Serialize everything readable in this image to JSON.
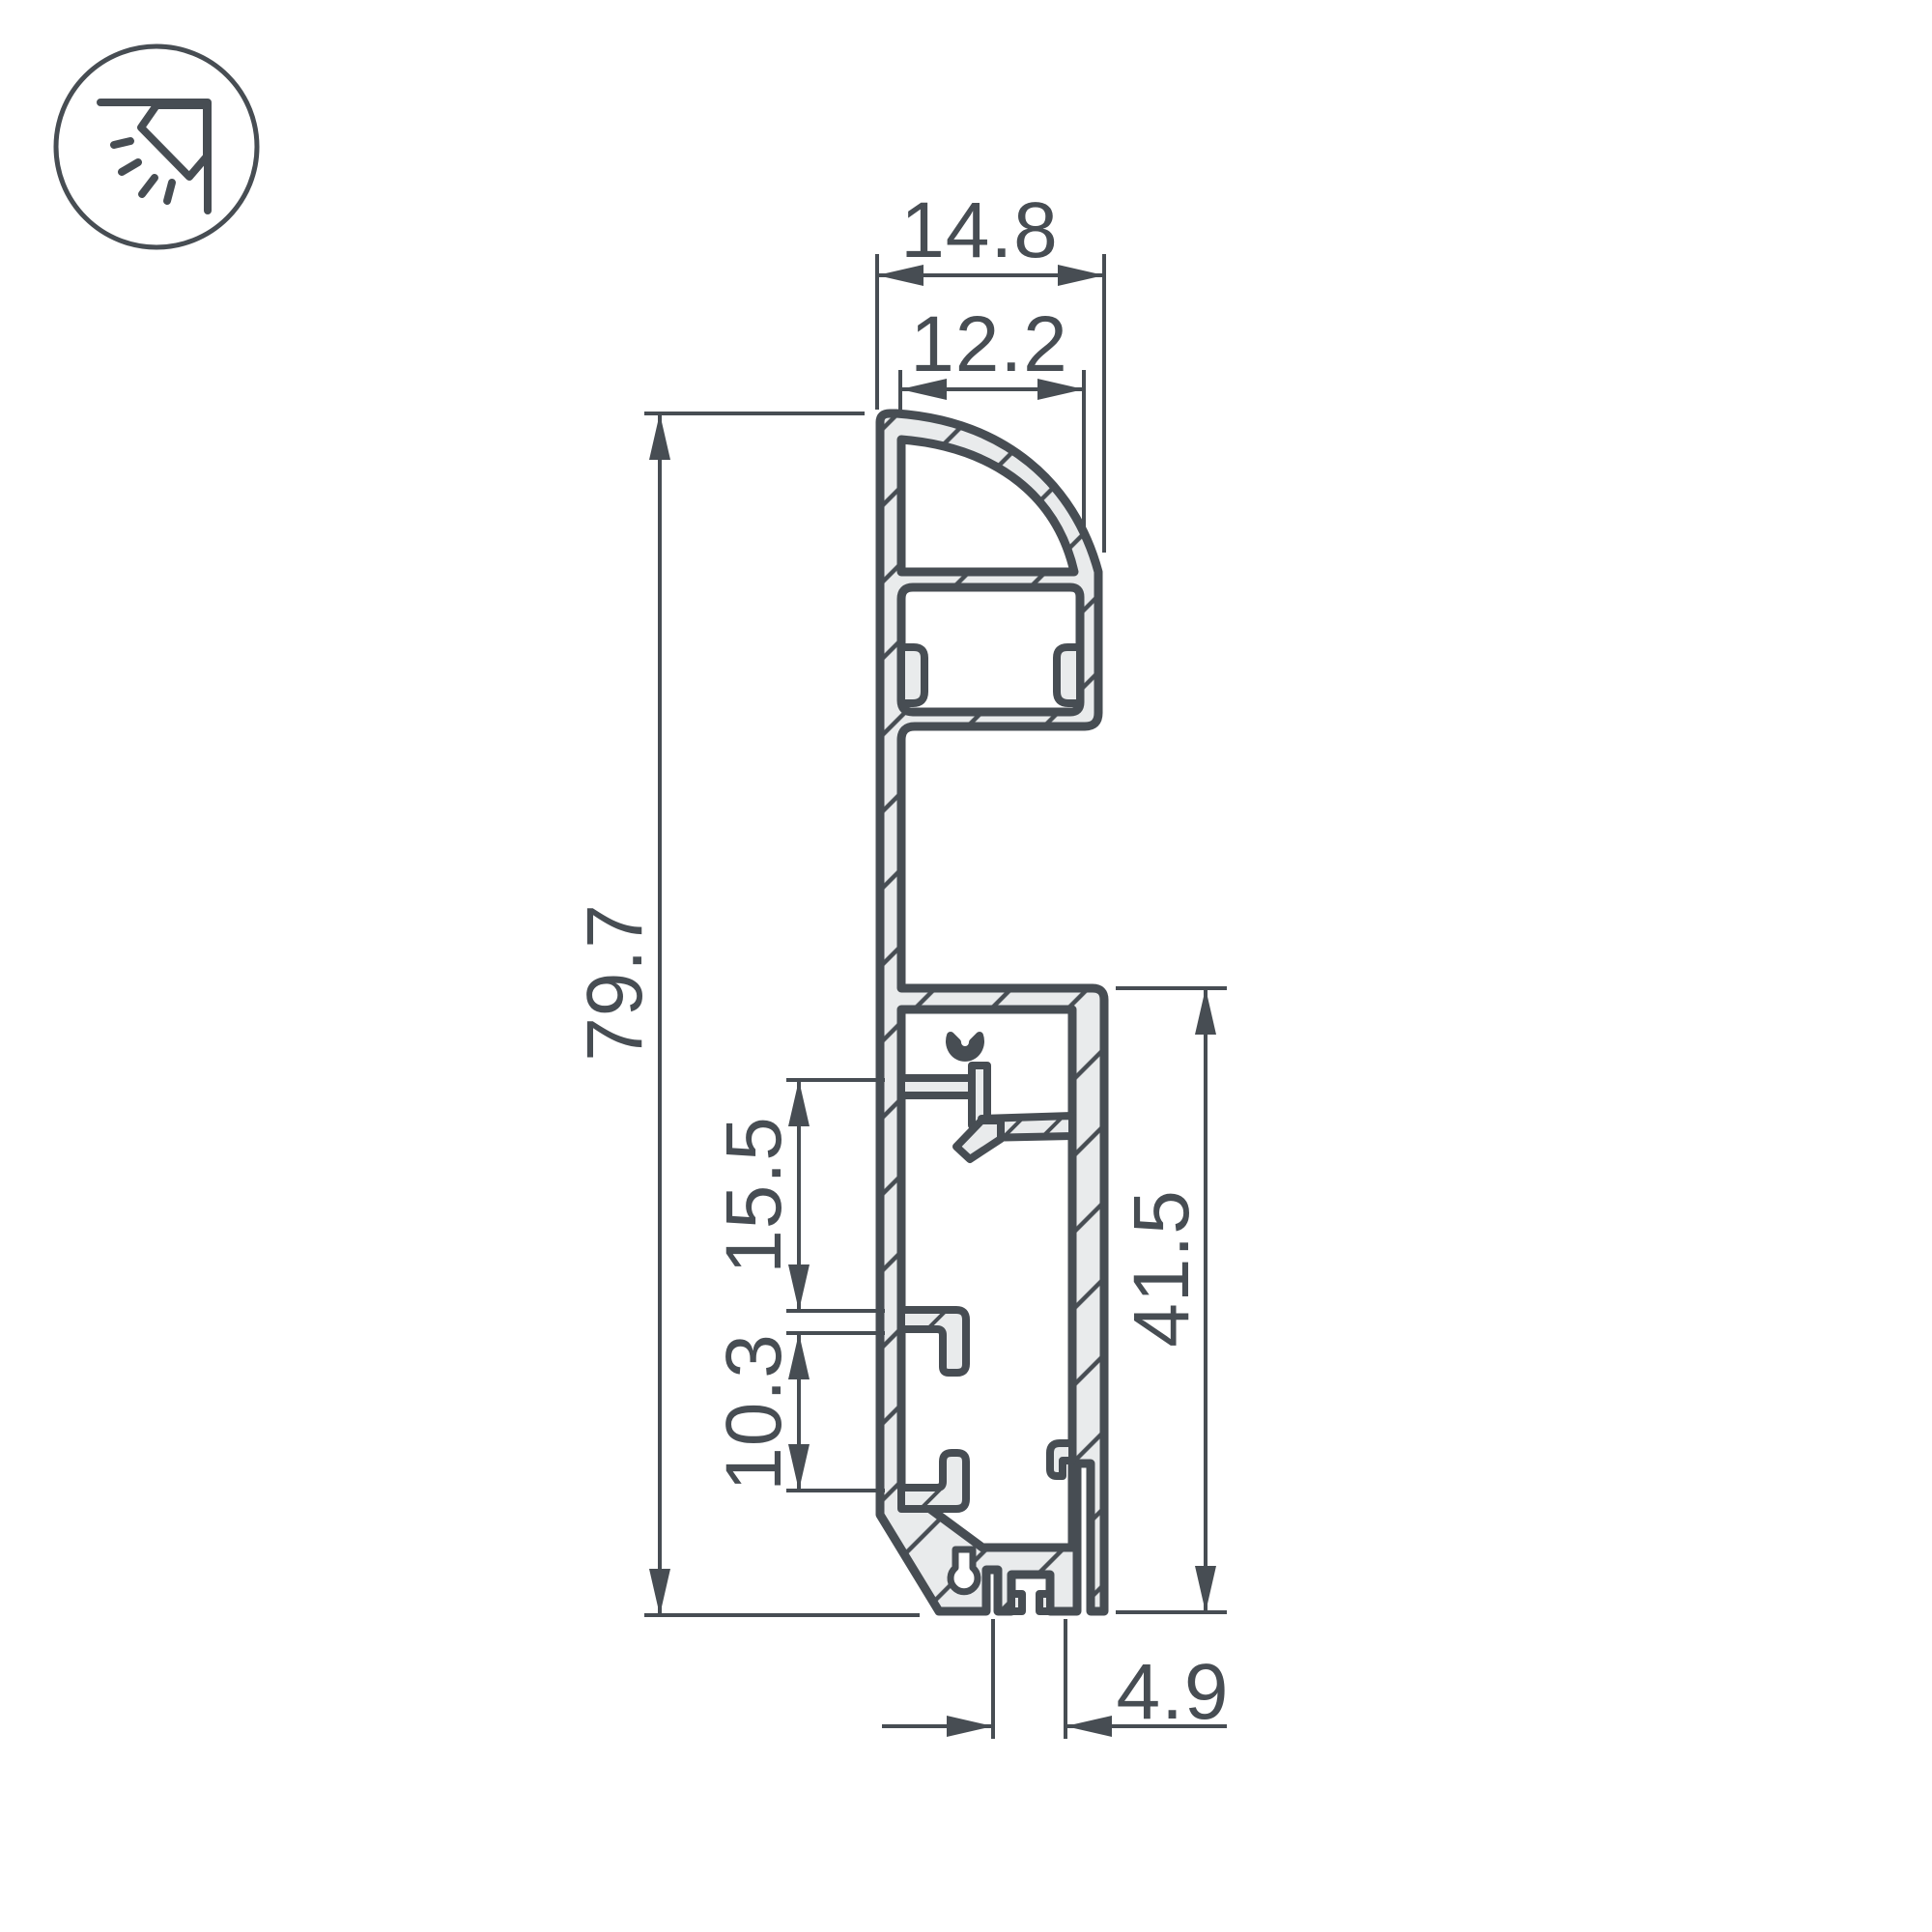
{
  "drawing": {
    "type": "profile-cross-section-technical-drawing",
    "colors": {
      "line": "#474d53",
      "material_fill": "#e9ebec",
      "background": "#ffffff"
    },
    "icon": {
      "name": "cornice-wall-washer-light-icon"
    },
    "dimensions": {
      "top_overall_width": {
        "value": "14.8"
      },
      "lens_opening_width": {
        "value": "12.2"
      },
      "overall_height": {
        "value": "79.7"
      },
      "upper_clip_gap": {
        "value": "15.5"
      },
      "lower_clip_gap": {
        "value": "10.3"
      },
      "base_section_height": {
        "value": "41.5"
      },
      "foot_width": {
        "value": "4.9"
      }
    }
  }
}
